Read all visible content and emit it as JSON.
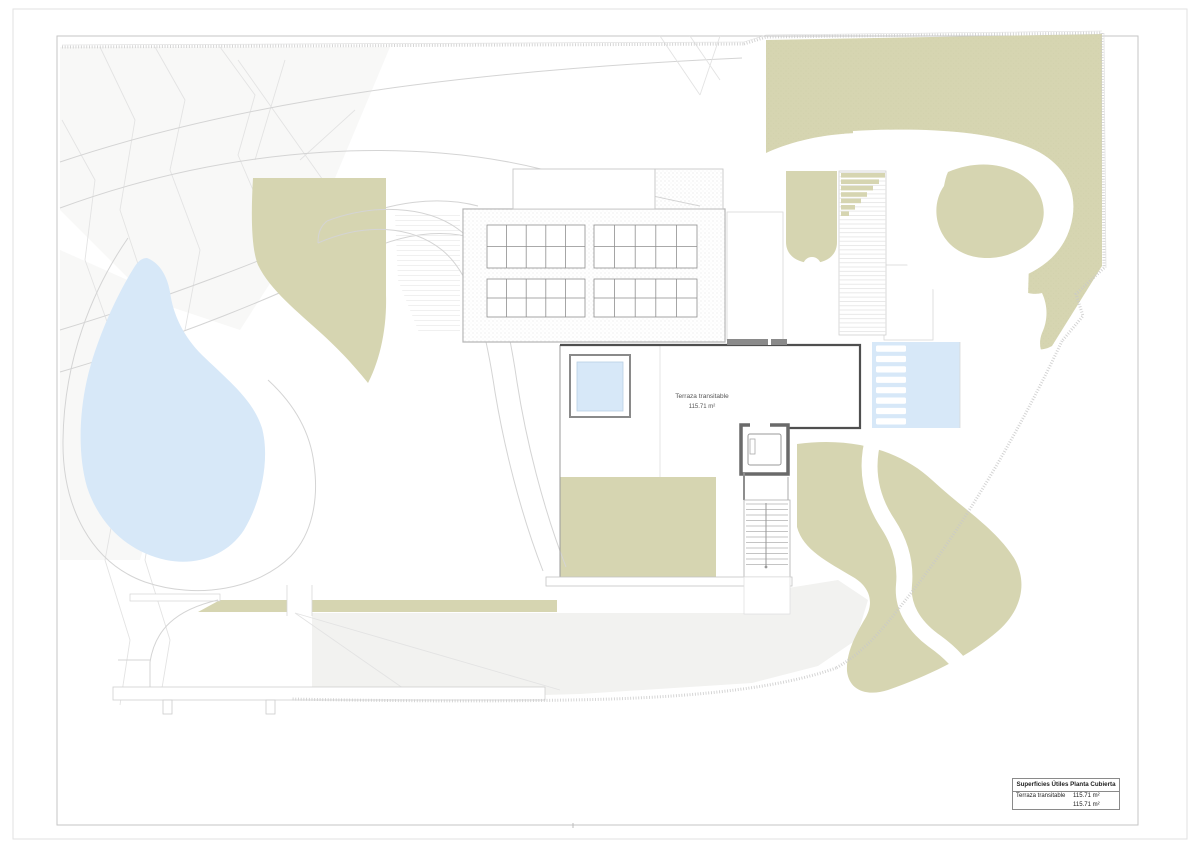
{
  "page": {
    "label": {
      "line1": "Terraza transitable",
      "line2": "115.71 m²"
    },
    "legend": {
      "title": "Superficies Útiles Planta Cubierta",
      "rows": [
        {
          "label": "Terraza transitable",
          "value": "115.71 m²"
        }
      ],
      "total": "115.71 m²"
    },
    "colors": {
      "vegetation": "#d6d5b1",
      "water": "#d7e8f8",
      "water_inner": "#cfe4f6",
      "wash": "#f2f2f0",
      "line": "#bdbdbd",
      "dark_line": "#4f4f4f"
    }
  }
}
